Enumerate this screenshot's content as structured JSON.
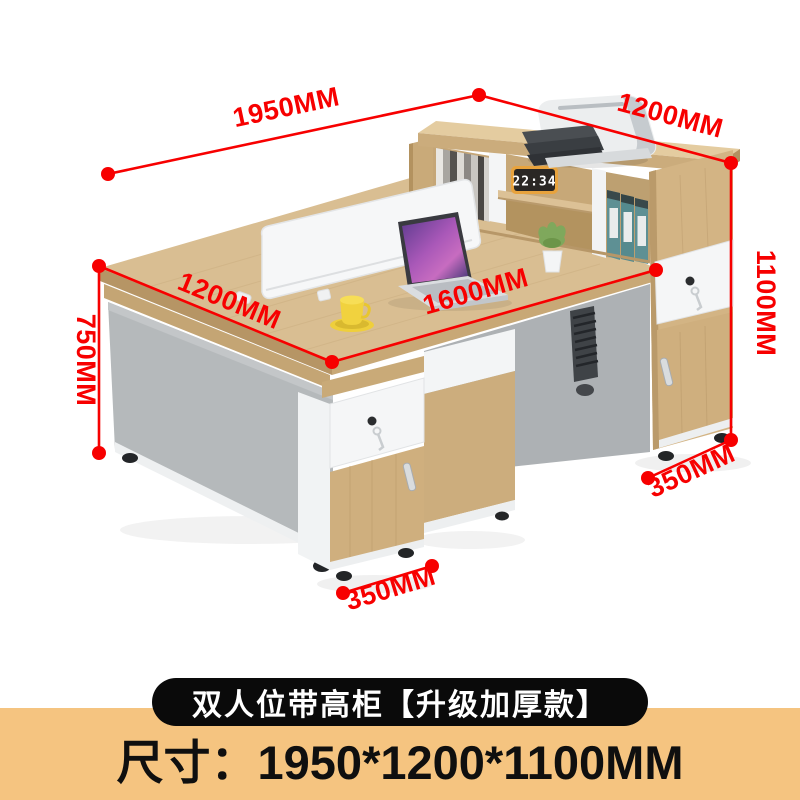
{
  "colors": {
    "accent_red": "#F70000",
    "band": "#F5C480",
    "banner_bg": "#0A0A0A",
    "wood_top": "#D9BE92",
    "wood_edge": "#B69565",
    "panel_gray": "#B5B9BB"
  },
  "annotations": {
    "top_width": "1950MM",
    "top_depth": "1200MM",
    "right_height": "1100MM",
    "right_cabinet_depth": "350MM",
    "left_height": "750MM",
    "desk_depth": "1200MM",
    "desk_width": "1600MM",
    "left_cabinet_depth": "350MM"
  },
  "decor": {
    "clock_time": "22:34"
  },
  "banner": {
    "label": "双人位带高柜【升级加厚款】"
  },
  "size_line": {
    "text": "尺寸：1950*1200*1100MM"
  }
}
